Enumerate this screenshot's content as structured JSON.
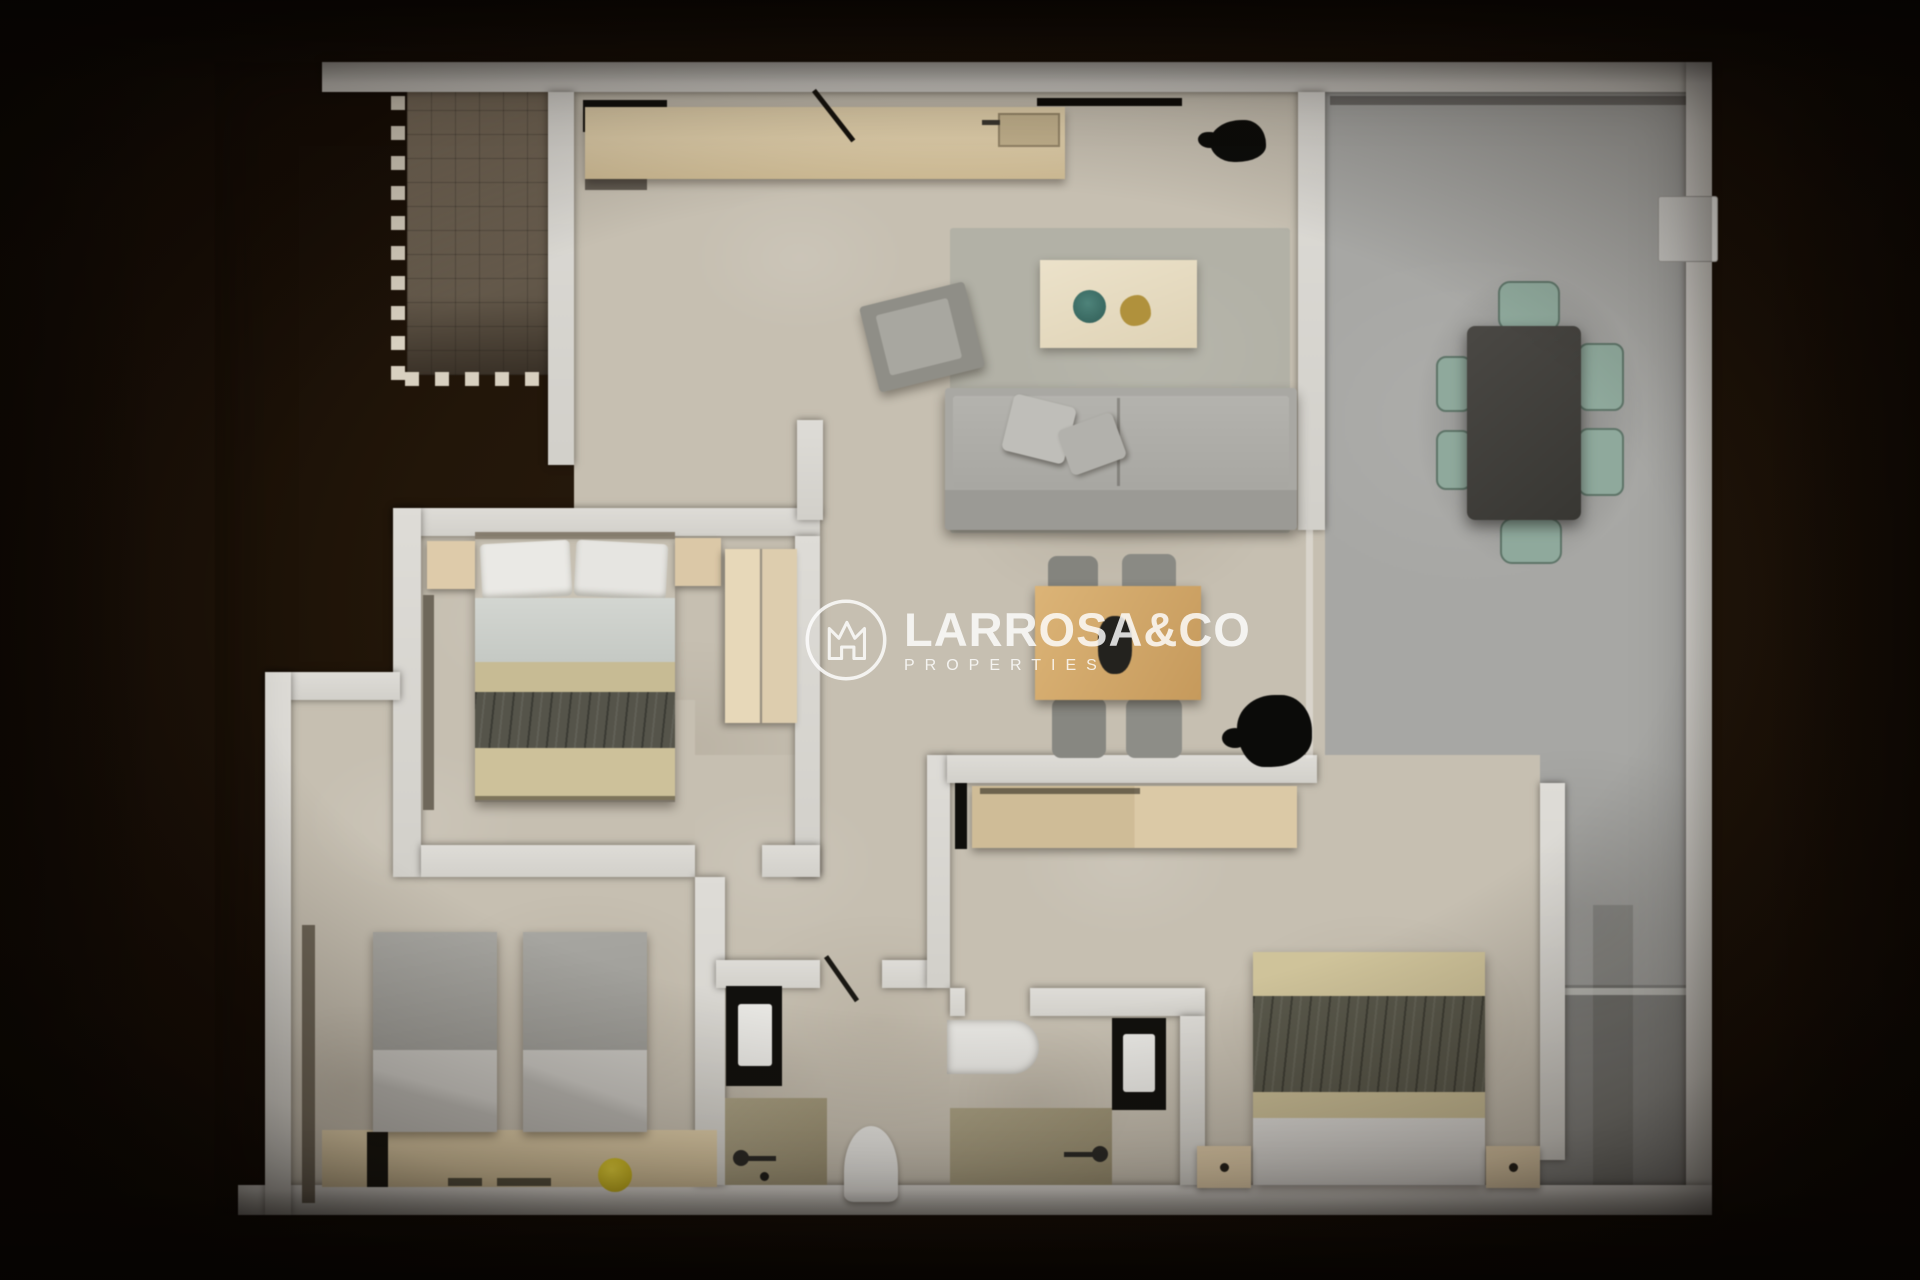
{
  "watermark": {
    "brand": "LARROSA&CO",
    "tagline": "PROPERTIES",
    "icon": "crown-house-logo-icon",
    "color": "#ffffff"
  },
  "palette": {
    "background": "#170f08",
    "wall": "#d9d7d2",
    "floor_beige": "#c6bfb1",
    "terrace_tile": "#6f6354",
    "patio_gray": "#a7a7a4",
    "shower_olive": "#a39a7e",
    "wood_light": "#dbc9a7",
    "wood_mid": "#d2a86b",
    "sofa_gray": "#a9a8a3",
    "bed_olive": "#59584b",
    "bed_khaki": "#cfc39a",
    "chair_sage": "#8fa99c",
    "table_dark": "#413f3b",
    "stool_yellow": "#d8c42a",
    "plate_teal": "#41756c",
    "decor_gold": "#b0913c"
  },
  "plan": {
    "type": "apartment-floor-plan-3d-render",
    "rooms": [
      {
        "name": "terrace",
        "floor": "brown-tile",
        "furniture": []
      },
      {
        "name": "kitchen",
        "floor": "beige",
        "furniture": [
          "counter",
          "cooktop",
          "sink"
        ]
      },
      {
        "name": "living-dining",
        "floor": "beige",
        "furniture": [
          "sofa",
          "armchair",
          "rug",
          "coffee-table",
          "dining-table",
          "four-chairs",
          "sideboard",
          "potted-plant"
        ]
      },
      {
        "name": "patio",
        "floor": "gray",
        "furniture": [
          "outdoor-table",
          "six-sage-chairs",
          "wall-unit"
        ]
      },
      {
        "name": "master-bedroom",
        "floor": "beige",
        "furniture": [
          "double-bed",
          "two-nightstands",
          "wardrobe",
          "radiator"
        ]
      },
      {
        "name": "twin-bedroom",
        "floor": "beige",
        "furniture": [
          "two-single-beds",
          "headboard-unit",
          "yellow-stool"
        ]
      },
      {
        "name": "bedroom-3",
        "floor": "beige",
        "furniture": [
          "double-bed",
          "two-nightstands",
          "sideboard"
        ]
      },
      {
        "name": "bathroom-1",
        "floor": "beige",
        "furniture": [
          "vanity-sink",
          "shower",
          "toilet"
        ]
      },
      {
        "name": "bathroom-2",
        "floor": "beige",
        "furniture": [
          "bathtub",
          "vanity-sink",
          "shower"
        ]
      }
    ]
  }
}
